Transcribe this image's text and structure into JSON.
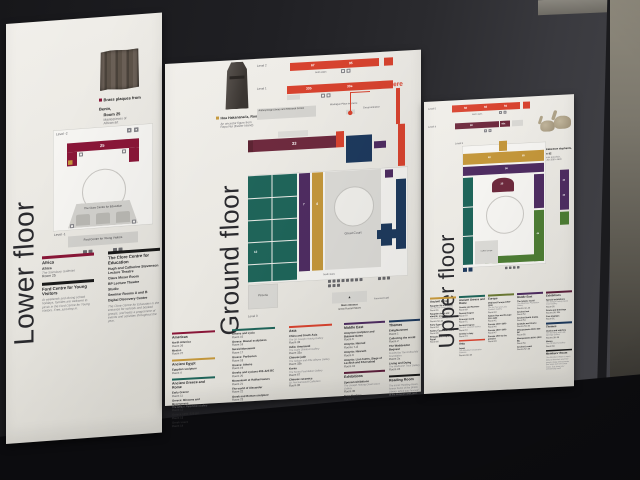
{
  "palette": {
    "africa_americas": "#8a1638",
    "ancient_egypt": "#c4973b",
    "greece_rome": "#1f655a",
    "asia": "#d8432f",
    "europe": "#6c7a34",
    "middle_east": "#4f2d62",
    "themes": "#1e3a5e",
    "exhibitions": "#5d1f3c",
    "black": "#1a1a1a",
    "you_are_here_red": "#d8432f",
    "map_grey": "#dcdbd7"
  },
  "panels": {
    "lower": {
      "title": "Lower floor",
      "highlight": {
        "title1": "Brass plaques from Benin,",
        "title2": "Room 25",
        "sub1": "Masterpieces of",
        "sub2": "African art"
      },
      "map": {
        "level2": "Level -2",
        "level1": "Level -1",
        "room25": "25",
        "clore": "The Clore Centre for Education",
        "ford": "Ford Centre for Young Visitors"
      },
      "legend": {
        "col1": {
          "sections": [
            {
              "title": "Africa",
              "color": "#8a1638",
              "entries": [
                {
                  "name": "Africa",
                  "sub": "The Sainsbury Galleries",
                  "room": "Room 25"
                }
              ]
            },
            {
              "title": "Ford Centre for Young Visitors",
              "color": "#1a1a1a",
              "entries": [
                {
                  "sub": "At weekends and during school holidays, families are welcome to picnic in the Ford Centre for Young Visitors. Free, just drop in."
                }
              ]
            }
          ]
        },
        "col2": {
          "sections": [
            {
              "title": "The Clore Centre for Education",
              "color": "#1a1a1a",
              "entries": [
                {
                  "name": "Hugh and Catherine Stevenson Lecture Theatre"
                },
                {
                  "name": "Claus Moser Room"
                },
                {
                  "name": "BP Lecture Theatre"
                },
                {
                  "name": "Studio"
                },
                {
                  "name": "Seminar Rooms A and B"
                },
                {
                  "name": "Digital Discovery Centre"
                },
                {
                  "sub": "The Clore Centre for Education is the entrance for schools and booked groups, and hosts a programme of events and activities throughout the year."
                }
              ]
            }
          ]
        }
      }
    },
    "ground": {
      "title": "Ground floor",
      "highlight": {
        "title1": "Hoa Hakananai'a, Room 24",
        "sub1": "An ancestor figure from",
        "sub2": "Rapa Nui (Easter Island)"
      },
      "map": {
        "level2": "Level 2",
        "level1": "Level 1",
        "level0": "Level 0",
        "you_are_here": "You are here",
        "north_stairs": "North stairs",
        "anthro": "Anthropology Library and Research Centre",
        "montague": "Montague Place entrance",
        "group_entrance": "Group entrance",
        "room67": "67",
        "room95": "95",
        "room33a": "33a",
        "room33b": "33b",
        "room33": "33",
        "room4": "4",
        "room7": "7",
        "room12": "12",
        "great_court": "Great Court",
        "south_stairs": "South stairs",
        "main_entrance": "Main entrance",
        "great_russell": "Great Russell Street",
        "forecourt": "Forecourt Café",
        "pizzeria": "Pizzeria"
      },
      "legend": {
        "col1": {
          "sections": [
            {
              "title": "Americas",
              "color": "#8a1638",
              "entries": [
                {
                  "name": "North America",
                  "room": "Room 26"
                },
                {
                  "name": "Mexico",
                  "room": "Room 27"
                }
              ]
            },
            {
              "title": "Ancient Egypt",
              "color": "#c4973b",
              "entries": [
                {
                  "name": "Egyptian sculpture",
                  "room": "Room 4"
                }
              ]
            },
            {
              "title": "Ancient Greece and Rome",
              "color": "#1f655a",
              "entries": [
                {
                  "name": "Early Greece",
                  "room": "Room 11"
                },
                {
                  "name": "Greece: Minoans and Mycenaeans",
                  "sub": "The Arthur I Fleischman Gallery",
                  "room": "Room 12"
                },
                {
                  "name": "Greece 1050–520 BC",
                  "room": "Room 13"
                },
                {
                  "name": "Greek vases",
                  "room": "Room 14"
                }
              ]
            }
          ]
        },
        "col2": {
          "sections": [
            {
              "title": "",
              "color": "#1f655a",
              "entries": [
                {
                  "name": "Athens and Lycia",
                  "room": "Room 15"
                },
                {
                  "name": "Greece: Bassai sculptures",
                  "room": "Room 16"
                },
                {
                  "name": "Nereid Monument",
                  "room": "Room 17"
                },
                {
                  "name": "Greece: Parthenon",
                  "room": "Room 18"
                },
                {
                  "name": "Greece: Athens",
                  "room": "Room 19"
                },
                {
                  "name": "Greeks and Lycians 400–325 BC",
                  "room": "Room 20"
                },
                {
                  "name": "Mausoleum at Halikarnassos",
                  "room": "Room 21"
                },
                {
                  "name": "The world of Alexander",
                  "room": "Room 22"
                },
                {
                  "name": "Greek and Roman sculpture",
                  "room": "Room 23"
                }
              ]
            }
          ]
        },
        "col3": {
          "sections": [
            {
              "title": "Asia",
              "color": "#d8432f",
              "entries": [
                {
                  "name": "China and South Asia",
                  "sub": "The Sir Joseph Hotung Gallery",
                  "room": "Room 33"
                },
                {
                  "name": "India: Amaravati",
                  "sub": "The Asahi Shimbun Gallery",
                  "room": "Room 33a"
                },
                {
                  "name": "Chinese jade",
                  "sub": "The Selwyn and Ellie Alleyne Gallery",
                  "room": "Room 33b"
                },
                {
                  "name": "Korea",
                  "sub": "The Korea Foundation Gallery",
                  "room": "Room 67"
                },
                {
                  "name": "Chinese ceramics",
                  "sub": "Sir Percival David Collection",
                  "room": "Room 95"
                }
              ]
            }
          ]
        },
        "col4": {
          "sections": [
            {
              "title": "Middle East",
              "color": "#4f2d62",
              "entries": [
                {
                  "name": "Assyrian sculpture and Balawat Gates",
                  "room": "Room 6"
                },
                {
                  "name": "Assyria: Nimrud",
                  "room": "Rooms 7–8"
                },
                {
                  "name": "Assyria: Nineveh",
                  "room": "Room 9"
                },
                {
                  "name": "Assyria: Lion hunts, Siege of Lachish and Khorsabad",
                  "room": "Room 10"
                }
              ]
            },
            {
              "title": "Exhibitions",
              "color": "#5d1f3c",
              "entries": [
                {
                  "name": "Special exhibitions",
                  "sub": "The Joseph Hotung Great Court Gallery",
                  "room": "Room 35"
                },
                {
                  "name": "Free displays",
                  "room": "Room 3"
                }
              ]
            }
          ]
        },
        "col5": {
          "sections": [
            {
              "title": "Themes",
              "color": "#1e3a5e",
              "entries": [
                {
                  "name": "Enlightenment",
                  "room": "Room 1"
                },
                {
                  "name": "Collecting the world",
                  "room": "Room 2"
                },
                {
                  "name": "The Waddesdon Bequest",
                  "sub": "Funded by The Rothschild Foundation",
                  "room": "Room 2a"
                },
                {
                  "name": "Living and Dying",
                  "sub": "The Wellcome Trust Gallery",
                  "room": "Room 24"
                }
              ]
            },
            {
              "title": "Reading Room",
              "color": "#1a1a1a",
              "entries": [
                {
                  "sub": "The iconic Reading Room, former home of the British Library, which was housed at the Museum until 1997."
                }
              ]
            }
          ]
        }
      }
    },
    "upper": {
      "title": "Upper floor",
      "highlight": {
        "title1": "The Kakiemon elephants,",
        "title2": "Room 92",
        "sub1": "Japanese porcelain,",
        "sub2": "about AD 1660–1690"
      },
      "map": {
        "level5": "Level 5",
        "level4": "Level 4",
        "level3": "Level 3",
        "north_stairs": "North stairs",
        "room92": "92",
        "room93": "93",
        "room94": "94",
        "room90": "90",
        "room90a": "90a",
        "room35": "35",
        "room56": "56",
        "room62": "62",
        "room65": "65",
        "room46": "46",
        "room42": "42",
        "room43": "43",
        "coffee": "Coffee lounge"
      },
      "legend": {
        "col1": {
          "sections": [
            {
              "title": "Ancient Egypt",
              "color": "#c4973b",
              "entries": [
                {
                  "name": "Egyptian life and death",
                  "sub": "The Michael Cohen Gallery",
                  "room": "Room 61"
                },
                {
                  "name": "Egyptian death and afterlife: mummies",
                  "sub": "The Roxie Walker Galleries",
                  "room": "Rooms 62–63"
                },
                {
                  "name": "Early Egypt",
                  "room": "Room 64"
                },
                {
                  "name": "Sudan, Egypt and Nubia",
                  "room": "Room 65"
                },
                {
                  "name": "Ethiopia and Coptic Egypt",
                  "room": "Room 66"
                }
              ]
            }
          ]
        },
        "col2": {
          "sections": [
            {
              "title": "Ancient Greece and Rome",
              "color": "#1f655a",
              "entries": [
                {
                  "name": "Greeks and Romans",
                  "room": "Room 69"
                },
                {
                  "name": "Roman Empire",
                  "room": "Room 70"
                },
                {
                  "name": "Etruscan world",
                  "room": "Room 71"
                },
                {
                  "name": "Ancient Cyprus",
                  "sub": "The A.G. Leventis Gallery",
                  "room": "Room 72"
                },
                {
                  "name": "Greeks in Italy",
                  "room": "Room 73"
                }
              ]
            },
            {
              "title": "Asia",
              "color": "#d8432f",
              "entries": [
                {
                  "name": "Japan",
                  "sub": "The Mitsubishi Corporation Galleries",
                  "room": "Rooms 92–94"
                }
              ]
            }
          ]
        },
        "col3": {
          "sections": [
            {
              "title": "Europe",
              "color": "#6c7a34",
              "entries": [
                {
                  "name": "Medieval Europe 1050–1500",
                  "sub": "The Sir Paul and Lady Ruddock Gallery",
                  "room": "Room 40"
                },
                {
                  "name": "Sutton Hoo and Europe 300–1100",
                  "room": "Room 41"
                },
                {
                  "name": "Europe 1400–1800",
                  "room": "Room 46"
                },
                {
                  "name": "Europe 1800–1900",
                  "room": "Room 47"
                },
                {
                  "name": "Europe 1900 to the present",
                  "room": "Room 48"
                }
              ]
            }
          ]
        },
        "col4": {
          "sections": [
            {
              "title": "Middle East",
              "color": "#4f2d62",
              "entries": [
                {
                  "name": "The Islamic world",
                  "sub": "The Albukhary Foundation Gallery",
                  "room": "Rooms 42–43"
                },
                {
                  "name": "Ancient Iran",
                  "room": "Room 52"
                },
                {
                  "name": "Ancient South Arabia",
                  "room": "Room 53"
                },
                {
                  "name": "Anatolia and Urartu",
                  "room": "Rooms 53–54"
                },
                {
                  "name": "Mesopotamia 1500–539 BC",
                  "room": "Room 55"
                },
                {
                  "name": "Mesopotamia 6000–1500 BC",
                  "room": "Room 56"
                },
                {
                  "name": "Ancient Levant",
                  "room": "Rooms 57–59"
                }
              ]
            }
          ]
        },
        "col5": {
          "sections": [
            {
              "title": "Exhibitions",
              "color": "#5d1f3c",
              "entries": [
                {
                  "name": "Special exhibitions",
                  "sub": "The Joseph Hotung Great Court Gallery",
                  "room": "Room 35"
                },
                {
                  "name": "Prints and drawings",
                  "room": "Rooms 90, 90a"
                },
                {
                  "name": "Free displays",
                  "room": "Room 91"
                }
              ]
            },
            {
              "title": "Themes",
              "color": "#1e3a5e",
              "entries": [
                {
                  "name": "Clocks and watches",
                  "sub": "The Sir Harry and Lady Djanogly Gallery",
                  "room": "Rooms 38–39"
                },
                {
                  "name": "Money",
                  "sub": "The Citi Money Gallery",
                  "room": "Room 68"
                }
              ]
            },
            {
              "title": "Members' Room",
              "color": "#1a1a1a",
              "entries": [
                {
                  "sub": "The Members' Room is open daily to Members and their guests. Enjoy refreshments and views over the Great Court. Just show your membership card."
                }
              ]
            }
          ]
        }
      }
    }
  }
}
